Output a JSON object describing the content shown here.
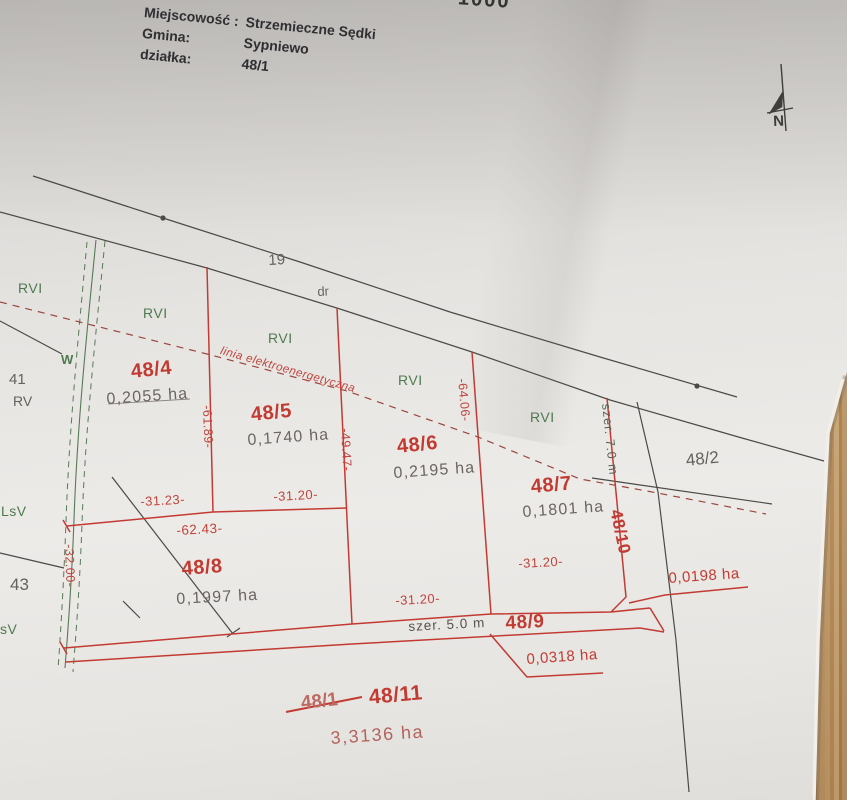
{
  "header": {
    "location_label": "Miejscowość :",
    "location": "Strzemieczne Sędki",
    "commune_label": "Gmina:",
    "commune": "Sypniewo",
    "parcel_label": "działka:",
    "parcel": "48/1"
  },
  "scale_fragment": "1000",
  "north": {
    "label": "N"
  },
  "road": {
    "number": "19",
    "use": "dr"
  },
  "power_line": {
    "label": "linia elektroenergetyczna"
  },
  "parcels": {
    "p48_4": {
      "number": "48/4",
      "area": "0,2055 ha"
    },
    "p48_5": {
      "number": "48/5",
      "area": "0,1740 ha"
    },
    "p48_6": {
      "number": "48/6",
      "area": "0,2195 ha"
    },
    "p48_7": {
      "number": "48/7",
      "area": "0,1801 ha"
    },
    "p48_8": {
      "number": "48/8",
      "area": "0,1997 ha"
    },
    "p48_9": {
      "number": "48/9",
      "area": "0,0318 ha"
    },
    "p48_10": {
      "number": "48/10",
      "area": "0,0198 ha"
    },
    "p48_11": {
      "number": "48/11",
      "area": "3,3136 ha"
    },
    "p48_2": {
      "number": "48/2"
    },
    "p48_1_old": {
      "number": "48/1",
      "struck": true
    }
  },
  "dimensions": {
    "w48_4_bottom": "-31.23-",
    "w48_5_bottom": "-31.20-",
    "w48_6_bottom": "-31.20-",
    "w48_7_bottom": "-31.20-",
    "w48_8_top": "-62.43-",
    "l48_4_east": "-61.89-",
    "l48_6_west": "-49.47-",
    "l48_6_east": "-64.06-",
    "l48_8_west": "-32.00-",
    "road_width_48_9": "szer. 5.0 m",
    "road_width_48_10": "szer. 7.0 m"
  },
  "land_use": {
    "rvi_1": "RVI",
    "rvi_2": "RVI",
    "rvi_3": "RVI",
    "rvi_4": "RVI",
    "rvi_5": "RVI",
    "rv": "RV",
    "w_ditch": "W",
    "lsv": "LsV",
    "sv": "sV"
  },
  "neighbours": {
    "n41": "41",
    "n43": "43"
  },
  "colors": {
    "line_red": "#c23b32",
    "ink": "#4b4a46",
    "ditch_green": "#567a54",
    "label_green": "#4e7a50",
    "area_text": "#6b6560",
    "faded_red": "#b2645c",
    "paper": "#e9e7e4",
    "wood": "#bb9160"
  }
}
